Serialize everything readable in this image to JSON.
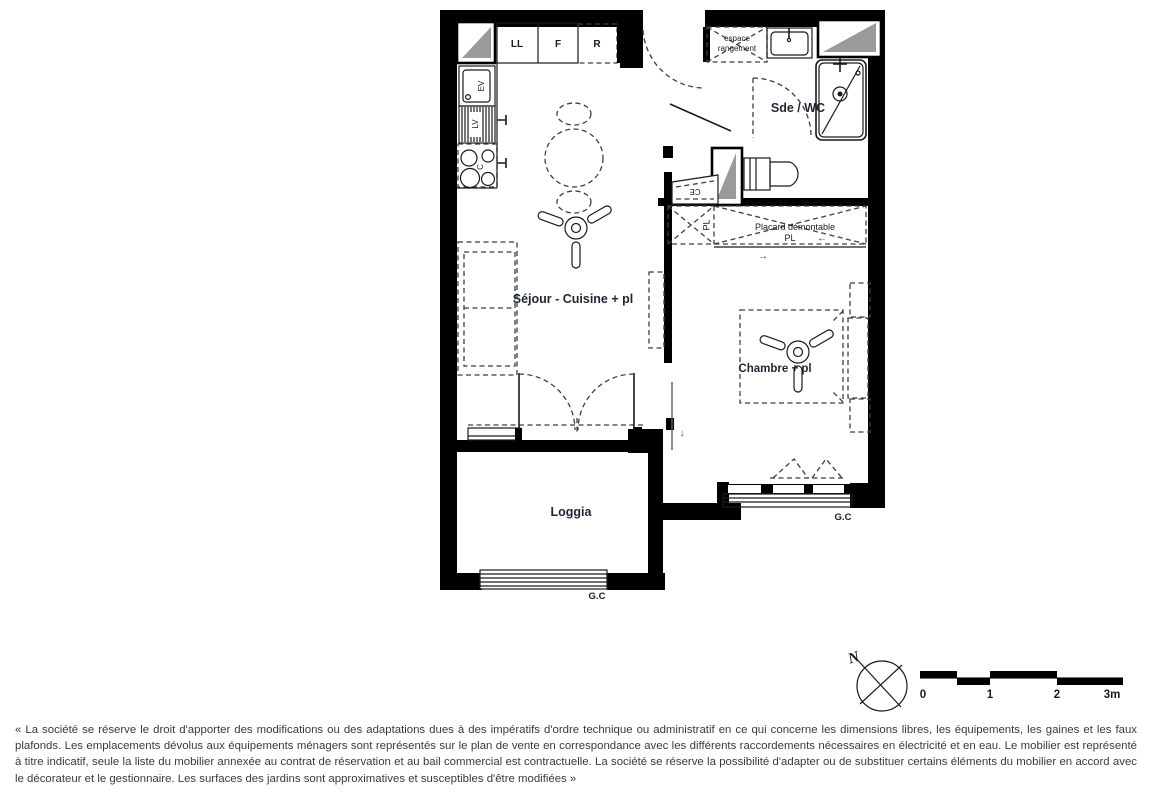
{
  "colors": {
    "wall": "#000000",
    "shade": "#9a9a9a",
    "label": "#1f2633",
    "disclaimer_text": "#3a3a3a"
  },
  "plan": {
    "room_labels": {
      "sejour": "Séjour - Cuisine + pl",
      "chambre": "Chambre + pl",
      "sde_wc": "Sde / WC",
      "loggia": "Loggia"
    },
    "kitchen": {
      "ll": "LL",
      "f": "F",
      "r": "R",
      "ev": "EV",
      "lv": "LV",
      "c": "C"
    },
    "storage": {
      "espace_line1": "espace",
      "espace_line2": "rangement",
      "placard_demontable": "Placard démontable",
      "placard_pl": "PL",
      "small_pl": "PL",
      "ce": "CE",
      "arrow_left": "←",
      "arrow_right": "→",
      "arrow_down": "↓"
    },
    "guardrails": {
      "loggia_gc": "G.C",
      "chambre_gc": "G.C"
    }
  },
  "compass": {
    "north": "N"
  },
  "scale_bar": {
    "tick0": "0",
    "tick1": "1",
    "tick2": "2",
    "tick3": "3m"
  },
  "disclaimer": {
    "text": "« La société se réserve le droit d'apporter des modifications ou des adaptations dues à des impératifs d'ordre technique ou administratif en ce qui concerne les dimensions libres, les équipements, les gaines et les faux plafonds. Les emplacements dévolus aux équipements ménagers sont représentés sur le plan de vente en correspondance avec les différents raccordements nécessaires en électricité et en eau. Le mobilier est représenté à titre indicatif, seule la liste du mobilier annexée au contrat de réservation et au bail commercial est contractuelle. La société se réserve la possibilité d'adapter ou de substituer certains éléments du mobilier en accord avec le décorateur et le gestionnaire. Les surfaces des jardins sont approximatives et susceptibles d'être modifiées »"
  }
}
